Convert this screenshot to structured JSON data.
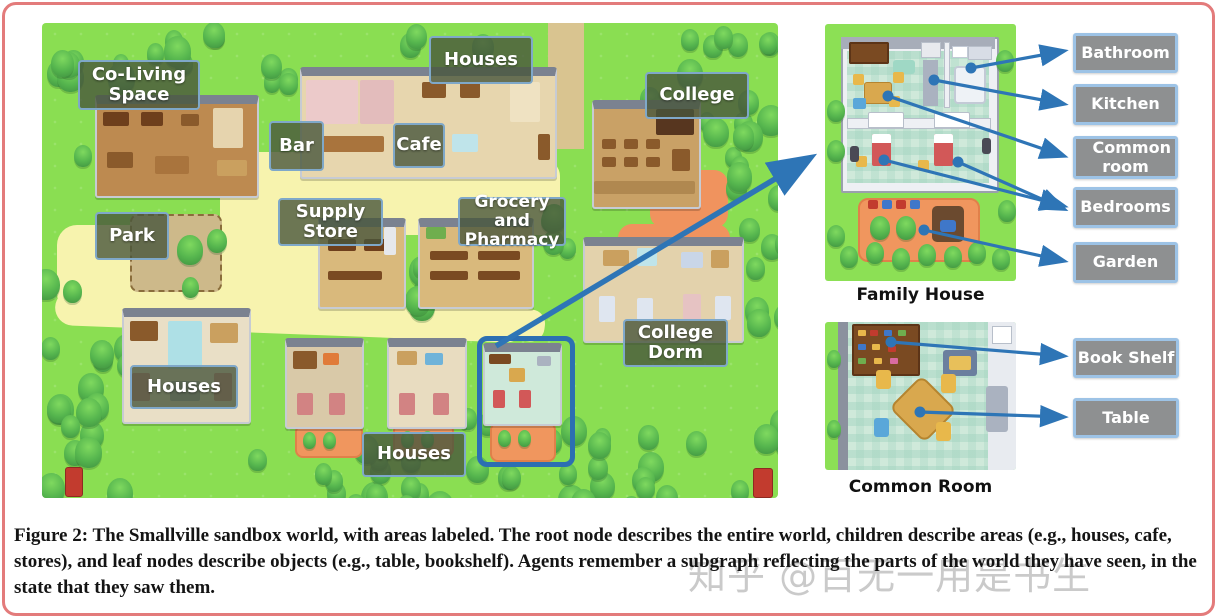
{
  "figure": {
    "caption": "Figure 2: The Smallville sandbox world, with areas labeled. The root node describes the entire world, children describe areas (e.g., houses, cafe, stores), and leaf nodes describe objects (e.g., table, bookshelf). Agents remember a subgraph reflecting the parts of the world they have seen, in the state that they saw them.",
    "watermark": "知乎 @百无一用是书生"
  },
  "map": {
    "area_labels": [
      {
        "id": "co-living-space",
        "label": "Co-Living Space"
      },
      {
        "id": "houses-north",
        "label": "Houses"
      },
      {
        "id": "bar",
        "label": "Bar"
      },
      {
        "id": "cafe",
        "label": "Cafe"
      },
      {
        "id": "college",
        "label": "College"
      },
      {
        "id": "supply-store",
        "label": "Supply Store"
      },
      {
        "id": "grocery-pharmacy",
        "label": "Grocery and Pharmacy"
      },
      {
        "id": "park",
        "label": "Park"
      },
      {
        "id": "houses-west",
        "label": "Houses"
      },
      {
        "id": "college-dorm",
        "label": "College Dorm"
      },
      {
        "id": "houses-south",
        "label": "Houses"
      }
    ]
  },
  "family_house": {
    "caption": "Family House",
    "room_labels": [
      {
        "label": "Bathroom"
      },
      {
        "label": "Kitchen"
      },
      {
        "label": "Common room"
      },
      {
        "label": "Bedrooms"
      },
      {
        "label": "Garden"
      }
    ]
  },
  "common_room": {
    "caption": "Common Room",
    "object_labels": [
      {
        "label": "Book Shelf"
      },
      {
        "label": "Table"
      }
    ]
  },
  "colors": {
    "arrow_blue": "#2e75b6",
    "map_label_fill": "rgba(72,86,60,0.8)",
    "map_label_border": "#7fa8c9",
    "gray_label_fill": "#8e9091",
    "gray_label_border": "#9dc3e6",
    "frame_border": "#e37b7b",
    "grass_green": "#8ade52",
    "path_yellow": "#f7f3ae"
  }
}
